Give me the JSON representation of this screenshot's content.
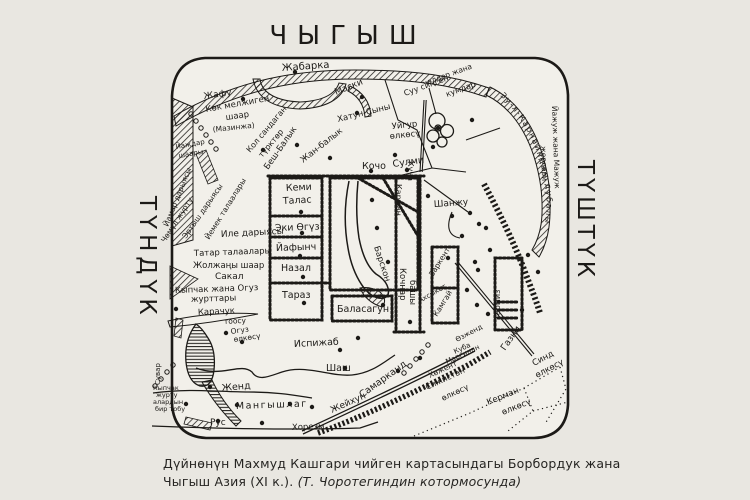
{
  "compass": {
    "east": "ЧЫГЫШ",
    "north": "ТҮНДҮК",
    "south": "ТҮШТҮК"
  },
  "caption": {
    "line1": "Дүйнөнүн Махмуд Кашгари чийген картасындагы Борбордук жана",
    "line2": "Чыгыш Азия (XI к.).",
    "line2_italic": "(Т. Чоротегиндин котормосунда)"
  },
  "map": {
    "ink": "#1c1a17",
    "paper": "#f2f0ea",
    "wall_text": "Зу-л-Карнайндын дубалы",
    "labels": [
      {
        "id": "jabarka",
        "t": "Жабарка",
        "x": 282,
        "y": 71,
        "r": -4,
        "s": 10
      },
      {
        "id": "jafu",
        "t": "Жафу",
        "x": 204,
        "y": 99,
        "r": -8,
        "s": 9
      },
      {
        "id": "kok-meljigen",
        "t": "Көк мелжиген",
        "x": 206,
        "y": 112,
        "r": -10,
        "s": 8.5
      },
      {
        "id": "kok-shaar",
        "t": "шаар",
        "x": 226,
        "y": 120,
        "r": -8,
        "s": 8.5
      },
      {
        "id": "mazinja",
        "t": "(Мазинжа)",
        "x": 213,
        "y": 132,
        "r": -6,
        "s": 7.5
      },
      {
        "id": "maski",
        "t": "Маски",
        "x": 336,
        "y": 95,
        "r": -22,
        "s": 9
      },
      {
        "id": "katun-syny",
        "t": "Хатун-Сыны",
        "x": 338,
        "y": 122,
        "r": -14,
        "s": 8.5
      },
      {
        "id": "suu-1",
        "t": "Суу сиңген",
        "x": 405,
        "y": 96,
        "r": -20,
        "s": 8
      },
      {
        "id": "suu-2",
        "t": "чөлдөр жана",
        "x": 424,
        "y": 86,
        "r": -20,
        "s": 7.5
      },
      {
        "id": "suu-3",
        "t": "кумдар",
        "x": 447,
        "y": 97,
        "r": -20,
        "s": 8
      },
      {
        "id": "uygur-1",
        "t": "Уйгур",
        "x": 392,
        "y": 129,
        "r": -6,
        "s": 8.5
      },
      {
        "id": "uygur-2",
        "t": "өлкөсү",
        "x": 390,
        "y": 139,
        "r": -6,
        "s": 8.5
      },
      {
        "id": "kol-1",
        "t": "Кол сандаган",
        "x": 250,
        "y": 153,
        "r": -50,
        "s": 8
      },
      {
        "id": "kol-2",
        "t": "түрктөр",
        "x": 262,
        "y": 158,
        "r": -50,
        "s": 8
      },
      {
        "id": "besh-balyk",
        "t": "Беш-Балык",
        "x": 268,
        "y": 170,
        "r": -55,
        "s": 8.5
      },
      {
        "id": "jan-balyk",
        "t": "Жан-балык",
        "x": 303,
        "y": 163,
        "r": -38,
        "s": 8.5
      },
      {
        "id": "kocho",
        "t": "Кочо",
        "x": 362,
        "y": 169,
        "r": 0,
        "s": 9.5
      },
      {
        "id": "sulmi",
        "t": "Сулми",
        "x": 393,
        "y": 167,
        "r": -8,
        "s": 9.5
      },
      {
        "id": "kemi",
        "t": "Кеми",
        "x": 286,
        "y": 191,
        "r": -3,
        "s": 9.5
      },
      {
        "id": "talas",
        "t": "Талас",
        "x": 283,
        "y": 204,
        "r": -3,
        "s": 9.5
      },
      {
        "id": "eki-oguz",
        "t": "Эки Өгүз",
        "x": 275,
        "y": 231,
        "r": -2,
        "s": 9.5
      },
      {
        "id": "yafynch",
        "t": "Йафынч",
        "x": 276,
        "y": 251,
        "r": -2,
        "s": 9.5
      },
      {
        "id": "nazal",
        "t": "Назал",
        "x": 281,
        "y": 271,
        "r": 0,
        "s": 9.5
      },
      {
        "id": "taraz",
        "t": "Тараз",
        "x": 282,
        "y": 298,
        "r": 0,
        "s": 9.5
      },
      {
        "id": "barskon",
        "t": "Барскон",
        "x": 374,
        "y": 247,
        "r": 72,
        "s": 8.5
      },
      {
        "id": "balasagun",
        "t": "Баласагун",
        "x": 337,
        "y": 312,
        "r": 0,
        "s": 9.5
      },
      {
        "id": "kochnar",
        "t": "Кочңар",
        "x": 400,
        "y": 268,
        "r": 90,
        "s": 8.5
      },
      {
        "id": "bashy",
        "t": "башы",
        "x": 410,
        "y": 280,
        "r": 90,
        "s": 8.5
      },
      {
        "id": "karman",
        "t": "Карман",
        "x": 396,
        "y": 184,
        "r": 90,
        "s": 8
      },
      {
        "id": "kucha",
        "t": "Куча",
        "x": 408,
        "y": 161,
        "r": 90,
        "s": 8
      },
      {
        "id": "shanju",
        "t": "Шанжу",
        "x": 434,
        "y": 207,
        "r": -4,
        "s": 9
      },
      {
        "id": "zarkent",
        "t": "Заркент",
        "x": 433,
        "y": 277,
        "r": -58,
        "s": 7.5
      },
      {
        "id": "kamgay",
        "t": "Камгай",
        "x": 437,
        "y": 317,
        "r": -58,
        "s": 7.5
      },
      {
        "id": "tarmiz",
        "t": "Тармиз",
        "x": 500,
        "y": 320,
        "r": -90,
        "s": 8
      },
      {
        "id": "ispijab",
        "t": "Испижаб",
        "x": 294,
        "y": 347,
        "r": -3,
        "s": 9.5
      },
      {
        "id": "shash",
        "t": "Шаш",
        "x": 326,
        "y": 371,
        "r": 0,
        "s": 9.5
      },
      {
        "id": "karachuk",
        "t": "Карачук",
        "x": 198,
        "y": 315,
        "r": -3,
        "s": 8.5
      },
      {
        "id": "toosu",
        "t": "тоосу",
        "x": 224,
        "y": 324,
        "r": -3,
        "s": 7.5
      },
      {
        "id": "oguz-1",
        "t": "Огуз",
        "x": 231,
        "y": 334,
        "r": -8,
        "s": 7.5
      },
      {
        "id": "oguz-2",
        "t": "өлкөсү",
        "x": 234,
        "y": 342,
        "r": -8,
        "s": 7.5
      },
      {
        "id": "kypchak-1",
        "t": "Кыпчак жана Огуз",
        "x": 175,
        "y": 293,
        "r": -2,
        "s": 8.5
      },
      {
        "id": "kypchak-2",
        "t": "журттары",
        "x": 191,
        "y": 302,
        "r": -2,
        "s": 8.5
      },
      {
        "id": "sakal",
        "t": "Сакал",
        "x": 215,
        "y": 279,
        "r": 0,
        "s": 9
      },
      {
        "id": "joljany-shaar",
        "t": "Жолжаңы шаар",
        "x": 193,
        "y": 268,
        "r": 0,
        "s": 8.5
      },
      {
        "id": "tatar",
        "t": "Татар талаалары",
        "x": 194,
        "y": 256,
        "r": -2,
        "s": 8.5
      },
      {
        "id": "ile",
        "t": "Иле дарыясы",
        "x": 221,
        "y": 237,
        "r": -3,
        "s": 9
      },
      {
        "id": "yemek",
        "t": "Йемек талаалары",
        "x": 209,
        "y": 240,
        "r": -58,
        "s": 7.5
      },
      {
        "id": "ertysh",
        "t": "Эртыш дарыясы",
        "x": 186,
        "y": 239,
        "r": -55,
        "s": 7.5
      },
      {
        "id": "chomul",
        "t": "Чөмүл журту",
        "x": 165,
        "y": 243,
        "r": -57,
        "s": 7.5
      },
      {
        "id": "yamar",
        "t": "Йамар дарыясы",
        "x": 168,
        "y": 227,
        "r": -68,
        "s": 7.5
      },
      {
        "id": "yajdar-1",
        "t": "Йаждар",
        "x": 176,
        "y": 149,
        "r": -10,
        "s": 7
      },
      {
        "id": "yajdar-2",
        "t": "шаары",
        "x": 179,
        "y": 158,
        "r": -10,
        "s": 7
      },
      {
        "id": "jend",
        "t": "Женд",
        "x": 222,
        "y": 391,
        "r": -5,
        "s": 9.5
      },
      {
        "id": "mangyshlag",
        "t": "Мангышлаг",
        "x": 236,
        "y": 409,
        "r": -2,
        "s": 9.5,
        "sp": 1.5
      },
      {
        "id": "rus",
        "t": "Рус",
        "x": 210,
        "y": 425,
        "r": 0,
        "s": 9
      },
      {
        "id": "khorezm",
        "t": "Хорезм",
        "x": 292,
        "y": 430,
        "r": -2,
        "s": 8.5
      },
      {
        "id": "jeyhun",
        "t": "Жейхун",
        "x": 332,
        "y": 413,
        "r": -24,
        "s": 9
      },
      {
        "id": "samarkand",
        "t": "Самарканд",
        "x": 362,
        "y": 398,
        "r": -36,
        "s": 9.5
      },
      {
        "id": "akhsyket",
        "t": "Ахсыкет",
        "x": 420,
        "y": 303,
        "r": -30,
        "s": 7
      },
      {
        "id": "ozjend",
        "t": "Өзженд",
        "x": 457,
        "y": 342,
        "r": -28,
        "s": 7
      },
      {
        "id": "kuba",
        "t": "Куба",
        "x": 455,
        "y": 354,
        "r": -25,
        "s": 7
      },
      {
        "id": "marginan",
        "t": "Маргинан",
        "x": 447,
        "y": 364,
        "r": -25,
        "s": 7
      },
      {
        "id": "khojent",
        "t": "Хөжент",
        "x": 430,
        "y": 378,
        "r": -25,
        "s": 7.5
      },
      {
        "id": "sijistan-1",
        "t": "Сижистан",
        "x": 427,
        "y": 390,
        "r": -25,
        "s": 8
      },
      {
        "id": "sijistan-2",
        "t": "өлкөсү",
        "x": 443,
        "y": 401,
        "r": -25,
        "s": 8
      },
      {
        "id": "gazni",
        "t": "Газни",
        "x": 505,
        "y": 351,
        "r": -55,
        "s": 9
      },
      {
        "id": "sind-1",
        "t": "Синд",
        "x": 534,
        "y": 366,
        "r": -28,
        "s": 8.5
      },
      {
        "id": "sind-2",
        "t": "өлкөсү",
        "x": 537,
        "y": 378,
        "r": -28,
        "s": 8.5
      },
      {
        "id": "kerman-1",
        "t": "Керман",
        "x": 488,
        "y": 405,
        "r": -22,
        "s": 8.5
      },
      {
        "id": "kerman-2",
        "t": "өлкөсү",
        "x": 503,
        "y": 415,
        "r": -22,
        "s": 8.5
      },
      {
        "id": "kypchak-small-1",
        "t": "Кыпчак",
        "x": 153,
        "y": 390,
        "r": 0,
        "s": 6.5
      },
      {
        "id": "kypchak-small-2",
        "t": "журту",
        "x": 156,
        "y": 397,
        "r": 0,
        "s": 6.5
      },
      {
        "id": "kypchak-small-3",
        "t": "алардын",
        "x": 153,
        "y": 404,
        "r": 0,
        "s": 6.5
      },
      {
        "id": "kypchak-small-4",
        "t": "бир тобу",
        "x": 155,
        "y": 411,
        "r": 0,
        "s": 6.5
      },
      {
        "id": "suvar",
        "t": "Сувар",
        "x": 160,
        "y": 385,
        "r": -90,
        "s": 7
      },
      {
        "id": "yajuj-1",
        "t": "Йажуж жана Мажуж",
        "x": 552,
        "y": 106,
        "r": 88,
        "s": 7.5
      },
      {
        "id": "yajuj-2",
        "t": "жерлери",
        "x": 541,
        "y": 146,
        "r": 88,
        "s": 7.5
      }
    ],
    "city_dots": [
      [
        243,
        99
      ],
      [
        295,
        72
      ],
      [
        362,
        97
      ],
      [
        357,
        113
      ],
      [
        438,
        128
      ],
      [
        472,
        120
      ],
      [
        263,
        150
      ],
      [
        297,
        145
      ],
      [
        330,
        158
      ],
      [
        371,
        171
      ],
      [
        407,
        170
      ],
      [
        395,
        155
      ],
      [
        433,
        147
      ],
      [
        301,
        212
      ],
      [
        302,
        233
      ],
      [
        300,
        256
      ],
      [
        303,
        277
      ],
      [
        304,
        303
      ],
      [
        372,
        200
      ],
      [
        377,
        228
      ],
      [
        388,
        262
      ],
      [
        383,
        305
      ],
      [
        428,
        196
      ],
      [
        452,
        216
      ],
      [
        470,
        213
      ],
      [
        462,
        236
      ],
      [
        479,
        224
      ],
      [
        486,
        228
      ],
      [
        490,
        250
      ],
      [
        475,
        262
      ],
      [
        448,
        258
      ],
      [
        478,
        270
      ],
      [
        467,
        290
      ],
      [
        477,
        305
      ],
      [
        488,
        314
      ],
      [
        528,
        255
      ],
      [
        538,
        272
      ],
      [
        522,
        310
      ],
      [
        176,
        309
      ],
      [
        226,
        333
      ],
      [
        242,
        342
      ],
      [
        210,
        387
      ],
      [
        186,
        404
      ],
      [
        237,
        405
      ],
      [
        290,
        404
      ],
      [
        312,
        407
      ],
      [
        218,
        421
      ],
      [
        262,
        423
      ],
      [
        340,
        350
      ],
      [
        345,
        368
      ],
      [
        398,
        371
      ],
      [
        420,
        358
      ],
      [
        358,
        338
      ],
      [
        410,
        322
      ]
    ],
    "circle_chains": [
      [
        [
          404,
          373
        ],
        [
          410,
          366
        ],
        [
          416,
          359
        ],
        [
          422,
          352
        ],
        [
          428,
          345
        ]
      ],
      [
        [
          155,
          386
        ],
        [
          161,
          379
        ],
        [
          167,
          372
        ],
        [
          173,
          365
        ]
      ],
      [
        [
          191,
          114
        ],
        [
          196,
          121
        ],
        [
          201,
          128
        ],
        [
          206,
          135
        ],
        [
          211,
          142
        ],
        [
          216,
          149
        ]
      ]
    ]
  }
}
